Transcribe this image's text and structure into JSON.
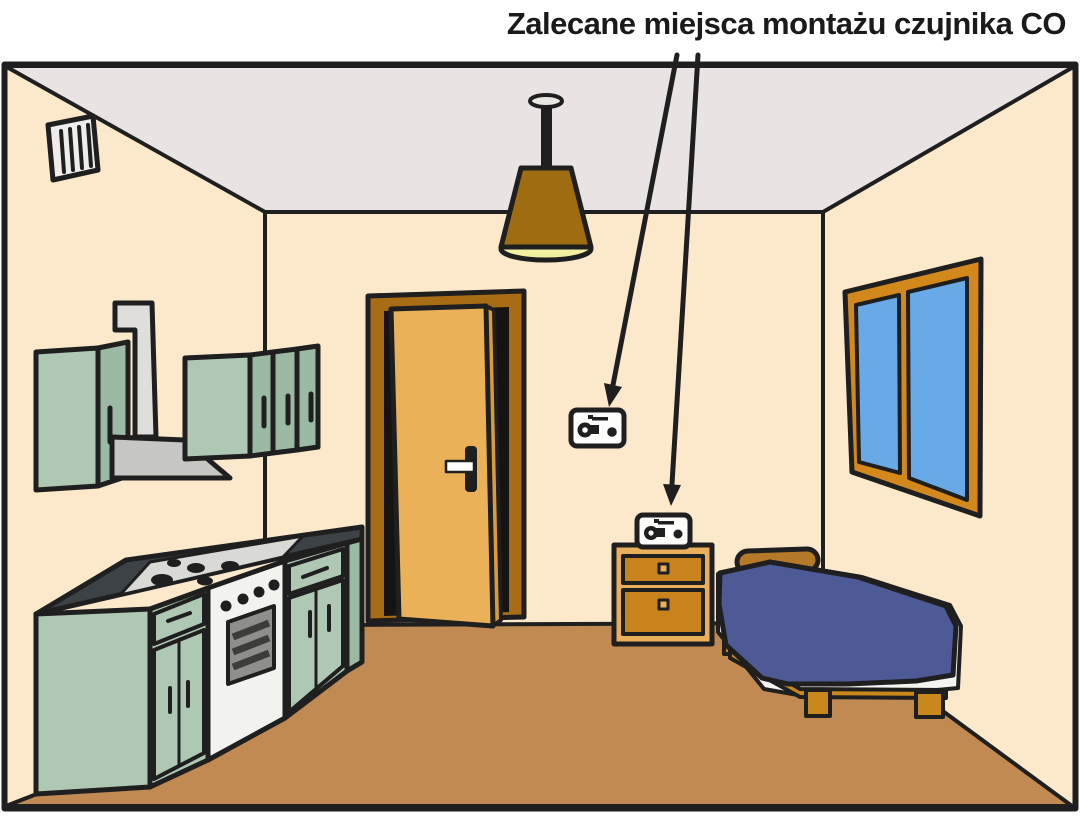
{
  "title": "Zalecane miejsca montażu czujnika CO",
  "arrows": {
    "count": 2,
    "targets": [
      "co-detector-on-wall",
      "co-detector-on-nightstand"
    ]
  },
  "scene_objects": [
    "ventilation-grille",
    "upper-kitchen-cabinets",
    "cooker-hood-duct",
    "kitchen-counter-with-stove",
    "interior-door",
    "ceiling-lamp",
    "co-detector-on-wall",
    "co-detector-on-nightstand",
    "nightstand",
    "single-bed",
    "window"
  ],
  "colors": {
    "background": "#ffffff",
    "outline": "#1f1f1f",
    "wall": "#fce8cb",
    "ceiling": "#eae3e3",
    "floor": "#c08a52",
    "cabinet_front": "#afc8b3",
    "cabinet_side": "#9cbaa3",
    "counter_top": "#3c4245",
    "cooktop": "#d9d9d5",
    "stove_front": "#f2f2ee",
    "oven_window": "#8e8e8a",
    "oven_stripe": "#3c3c3a",
    "duct": "#e0dedd",
    "hood": "#c6c6c2",
    "vent_face": "#efedeb",
    "door_frame": "#a86c15",
    "door_leaf": "#eab159",
    "door_leaf_edge": "#d99b3e",
    "door_opening": "#161412",
    "lamp_shade": "#a06c12",
    "lamp_light": "#f2efa0",
    "lamp_mount": "#eae6e2",
    "window_frame": "#d3881c",
    "window_glass": "#68a9e8",
    "nightstand_body": "#eaaf5b",
    "nightstand_drawer": "#c9831d",
    "bed_blanket": "#4d5a96",
    "bed_sheet": "#f4f4f0",
    "bed_frame": "#c9871c",
    "pillow": "#b5792a",
    "detector_face": "#fdfdfb"
  }
}
